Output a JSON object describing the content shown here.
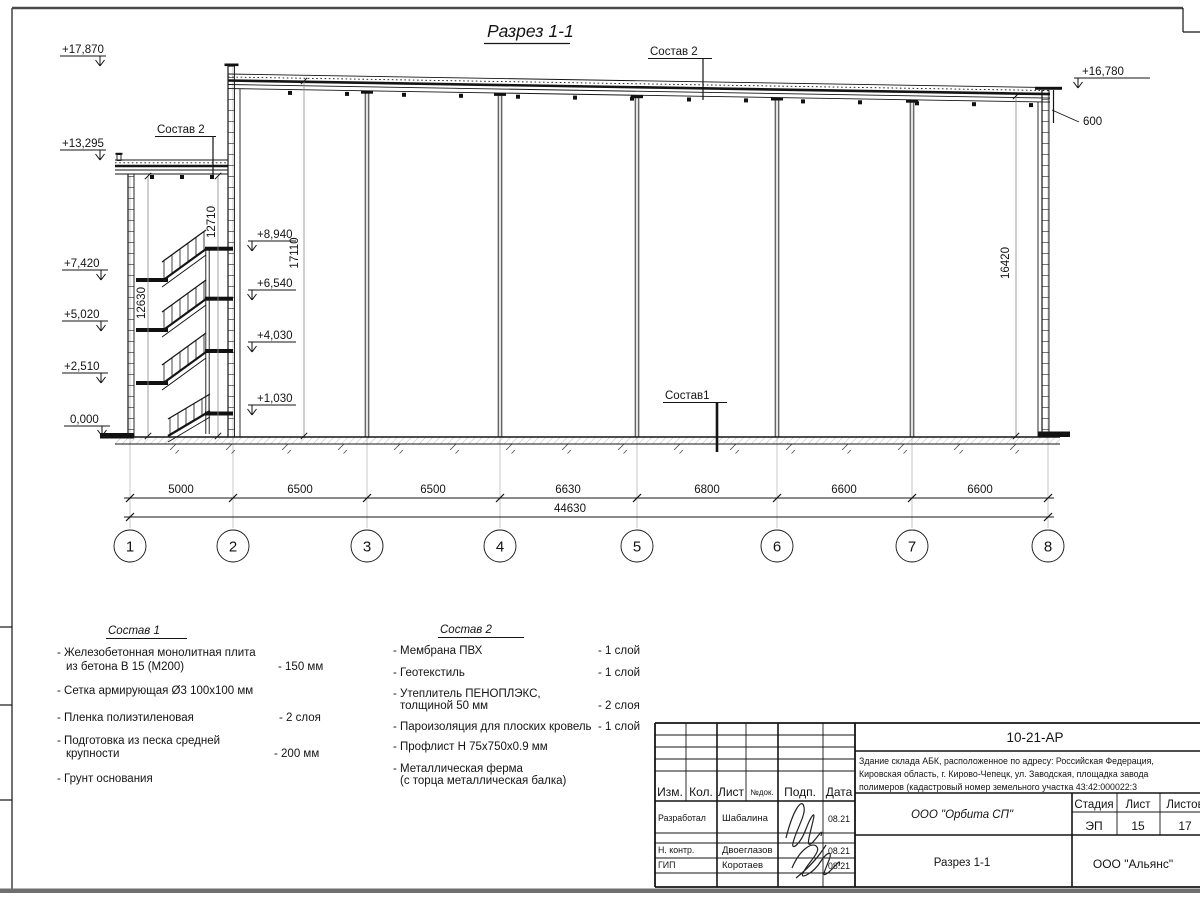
{
  "drawing": {
    "view_title": "Разрез 1-1",
    "elevations": {
      "left": [
        "+17,870",
        "+13,295",
        "+7,420",
        "+5,020",
        "+2,510",
        "0,000"
      ],
      "inner": [
        "+8,940",
        "+6,540",
        "+4,030",
        "+1,030"
      ],
      "right": "+16,780"
    },
    "dims": {
      "parapet": "600",
      "vertical": [
        "12710",
        "12630",
        "17110",
        "16420"
      ],
      "spans": [
        "5000",
        "6500",
        "6500",
        "6630",
        "6800",
        "6600",
        "6600"
      ],
      "total": "44630"
    },
    "axes": [
      "1",
      "2",
      "3",
      "4",
      "5",
      "6",
      "7",
      "8"
    ],
    "callouts": {
      "roof_top": "Состав 2",
      "roof_abk": "Состав 2",
      "floor": "Состав1"
    }
  },
  "legend1": {
    "title": "Состав 1",
    "items": [
      {
        "l1": "- Железобетонная  монолитная плита",
        "l2": "из бетона В 15 (М200)",
        "v": "- 150 мм"
      },
      {
        "l1": "- Сетка армирующая Ø3 100х100 мм",
        "l2": "",
        "v": ""
      },
      {
        "l1": "- Пленка полиэтиленовая",
        "l2": "",
        "v": "-  2 слоя"
      },
      {
        "l1": "- Подготовка из песка средней",
        "l2": "крупности",
        "v": "- 200 мм"
      },
      {
        "l1": "- Грунт основания",
        "l2": "",
        "v": ""
      }
    ]
  },
  "legend2": {
    "title": "Состав 2",
    "items": [
      {
        "l1": "- Мембрана ПВХ",
        "l2": "",
        "v": "- 1 слой"
      },
      {
        "l1": "- Геотекстиль",
        "l2": "",
        "v": "- 1 слой"
      },
      {
        "l1": "- Утеплитель ПЕНОПЛЭКС,",
        "l2": "толщиной 50 мм",
        "v": "- 2 слоя"
      },
      {
        "l1": "- Пароизоляция для плоских кровель",
        "l2": "",
        "v": "- 1 слой"
      },
      {
        "l1": "- Профлист Н 75х750х0.9 мм",
        "l2": "",
        "v": ""
      },
      {
        "l1": "- Металлическая ферма",
        "l2": "(с торца металлическая балка)",
        "v": ""
      }
    ]
  },
  "stamp": {
    "doc_number": "10-21-АР",
    "project_line1": "Здание склада АБК, расположенное по адресу: Российская Федерация,",
    "project_line2": "Кировская область, г. Кирово-Чепецк, ул. Заводская, площадка завода",
    "project_line3": "полимеров (кадастровый номер земельного участка 43:42:000022:3",
    "cols": {
      "izm": "Изм.",
      "kol": "Кол.",
      "list": "Лист",
      "ndok": "№док.",
      "podp": "Подп.",
      "data": "Дата"
    },
    "rows": [
      {
        "role": "Разработал",
        "name": "Шабалина",
        "date": "08.21"
      },
      {
        "role": "Н. контр.",
        "name": "Двоеглазов",
        "date": "08.21"
      },
      {
        "role": "ГИП",
        "name": "Коротаев",
        "date": "08.21"
      }
    ],
    "org_design": "ООО \"Орбита СП\"",
    "stage_label": "Стадия",
    "sheet_label": "Лист",
    "sheets_label": "Листов",
    "stage": "ЭП",
    "sheet_no": "15",
    "sheets_total": "17",
    "view_name": "Разрез 1-1",
    "org_general": "ООО \"Альянс\""
  }
}
